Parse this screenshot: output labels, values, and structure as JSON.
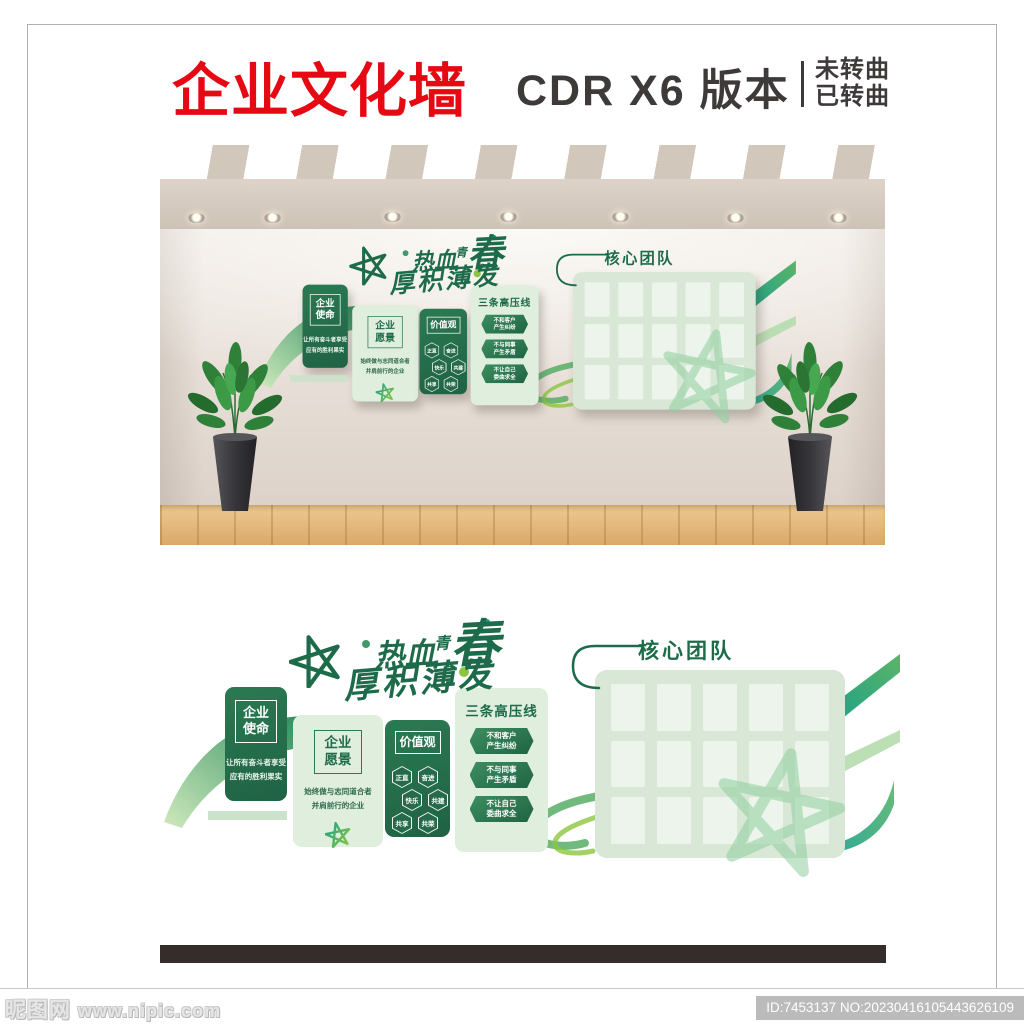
{
  "header": {
    "title": "企业文化墙",
    "subtitle": "CDR X6 版本",
    "note_line1": "未转曲",
    "note_line2": "已转曲"
  },
  "design": {
    "slogan": {
      "part1": "热血",
      "part2": "青",
      "part3": "春",
      "line2": "厚积薄发"
    },
    "mission": {
      "title_line1": "企业",
      "title_line2": "使命",
      "body_line1": "让所有奋斗者享受",
      "body_line2": "应有的胜利果实"
    },
    "vision": {
      "title_line1": "企业",
      "title_line2": "愿景",
      "body_line1": "始终做与志同道合者",
      "body_line2": "并肩前行的企业"
    },
    "values": {
      "title": "价值观",
      "items": [
        "正直",
        "奋进",
        "快乐",
        "共建",
        "共享",
        "共荣"
      ]
    },
    "redlines": {
      "title": "三条高压线",
      "items": [
        {
          "line1": "不和客户",
          "line2": "产生纠纷"
        },
        {
          "line1": "不与同事",
          "line2": "产生矛盾"
        },
        {
          "line1": "不让自己",
          "line2": "委曲求全"
        }
      ]
    },
    "team": {
      "title": "核心团队",
      "photo_rows": 3,
      "photo_cols": 5
    }
  },
  "colors": {
    "title_red": "#e60914",
    "header_dark": "#3e3a39",
    "brand_green": "#1e6b4a",
    "panel_dark_green": "#256b4a",
    "panel_light_green": "#dfeedd",
    "accent_lime": "#8cc63f",
    "accent_teal": "#18a08b",
    "wall_beige": "#e9e1da",
    "floor_wood": "#d9a968"
  },
  "footer": {
    "watermark": "昵图网",
    "site": "www.nipic.com",
    "id_text": "ID:7453137 NO:20230416105443626109"
  }
}
